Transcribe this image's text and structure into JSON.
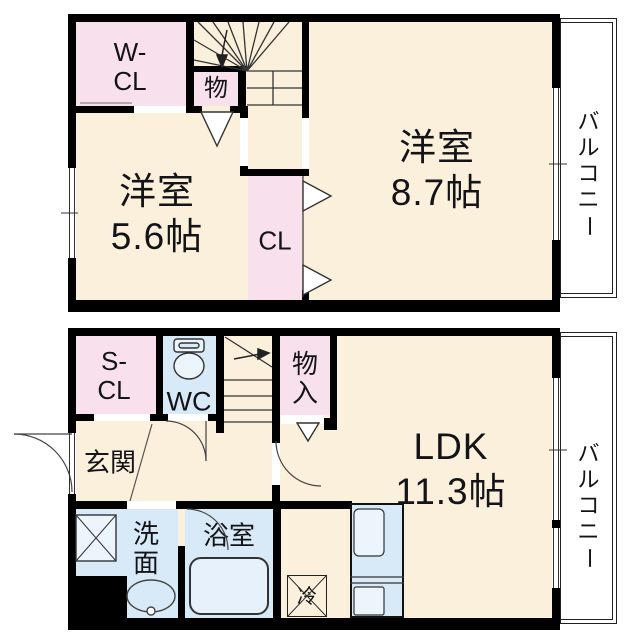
{
  "plan_title": "2-story maisonette floor plan",
  "colors": {
    "wall": "#000000",
    "floor": "#FAF0DB",
    "closet": "#F8E1ED",
    "wet_area": "#D8EAF7",
    "balcony": "#FFFFFF"
  },
  "floor_2f": {
    "rooms": {
      "wcl": {
        "line1": "W-",
        "line2": "CL"
      },
      "mono": "物",
      "cl": "CL",
      "room56": {
        "name": "洋室",
        "size": "5.6帖"
      },
      "room87": {
        "name": "洋室",
        "size": "8.7帖"
      },
      "balcony": [
        "バ",
        "ル",
        "コ",
        "ニ",
        "ー"
      ]
    }
  },
  "floor_1f": {
    "rooms": {
      "scl": {
        "line1": "S-",
        "line2": "CL"
      },
      "wc": "WC",
      "monoiri": {
        "line1": "物",
        "line2": "入"
      },
      "genkan": "玄関",
      "ldk": {
        "name": "LDK",
        "size": "11.3帖"
      },
      "washer": "洗",
      "senmen": {
        "line1": "洗",
        "line2": "面"
      },
      "bath": "浴室",
      "fridge": "冷",
      "balcony": [
        "バ",
        "ル",
        "コ",
        "ニ",
        "ー"
      ]
    }
  }
}
